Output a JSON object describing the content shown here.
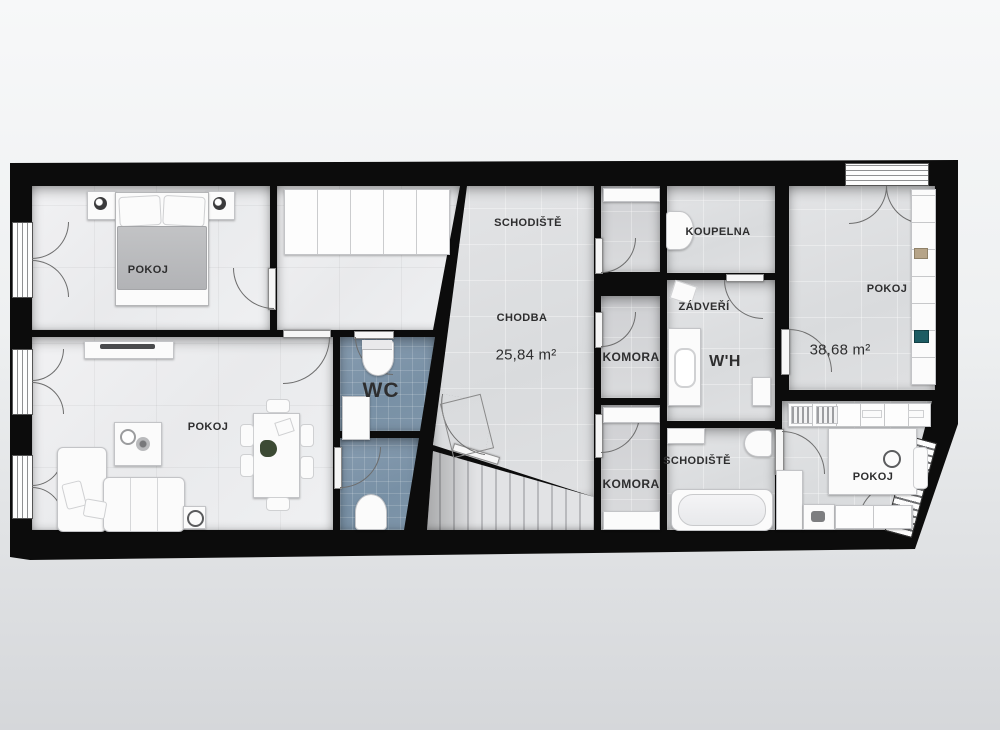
{
  "palette": {
    "wall": "#0c0c0c",
    "floor_marble": "#ededef",
    "floor_gray": "#dcdee0",
    "floor_wc_blue": "#7e95a9",
    "furniture_white": "#fbfbfb",
    "label_color": "#2e2e2f",
    "background_top": "#f7f8f9",
    "background_bottom": "#d5d7da"
  },
  "rooms": [
    {
      "id": "bedroom-top-left",
      "label": "POKOJ"
    },
    {
      "id": "living-room",
      "label": "POKOJ"
    },
    {
      "id": "wc",
      "label": "WC"
    },
    {
      "id": "staircase-hall",
      "label": "SCHODIŠTĚ"
    },
    {
      "id": "corridor",
      "label": "CHODBA",
      "area": "25,84 m²"
    },
    {
      "id": "komora-middle",
      "label": "KOMORA"
    },
    {
      "id": "komora-lower",
      "label": "KOMORA"
    },
    {
      "id": "koupelna",
      "label": "KOUPELNA"
    },
    {
      "id": "zadveri",
      "label": "ZÁDVEŘÍ"
    },
    {
      "id": "wh",
      "label": "W'H"
    },
    {
      "id": "bathroom",
      "label": "SCHODIŠTĚ"
    },
    {
      "id": "room-right-top",
      "label": "POKOJ",
      "area": "38,68 m²"
    },
    {
      "id": "room-right-bottom",
      "label": "POKOJ"
    }
  ]
}
